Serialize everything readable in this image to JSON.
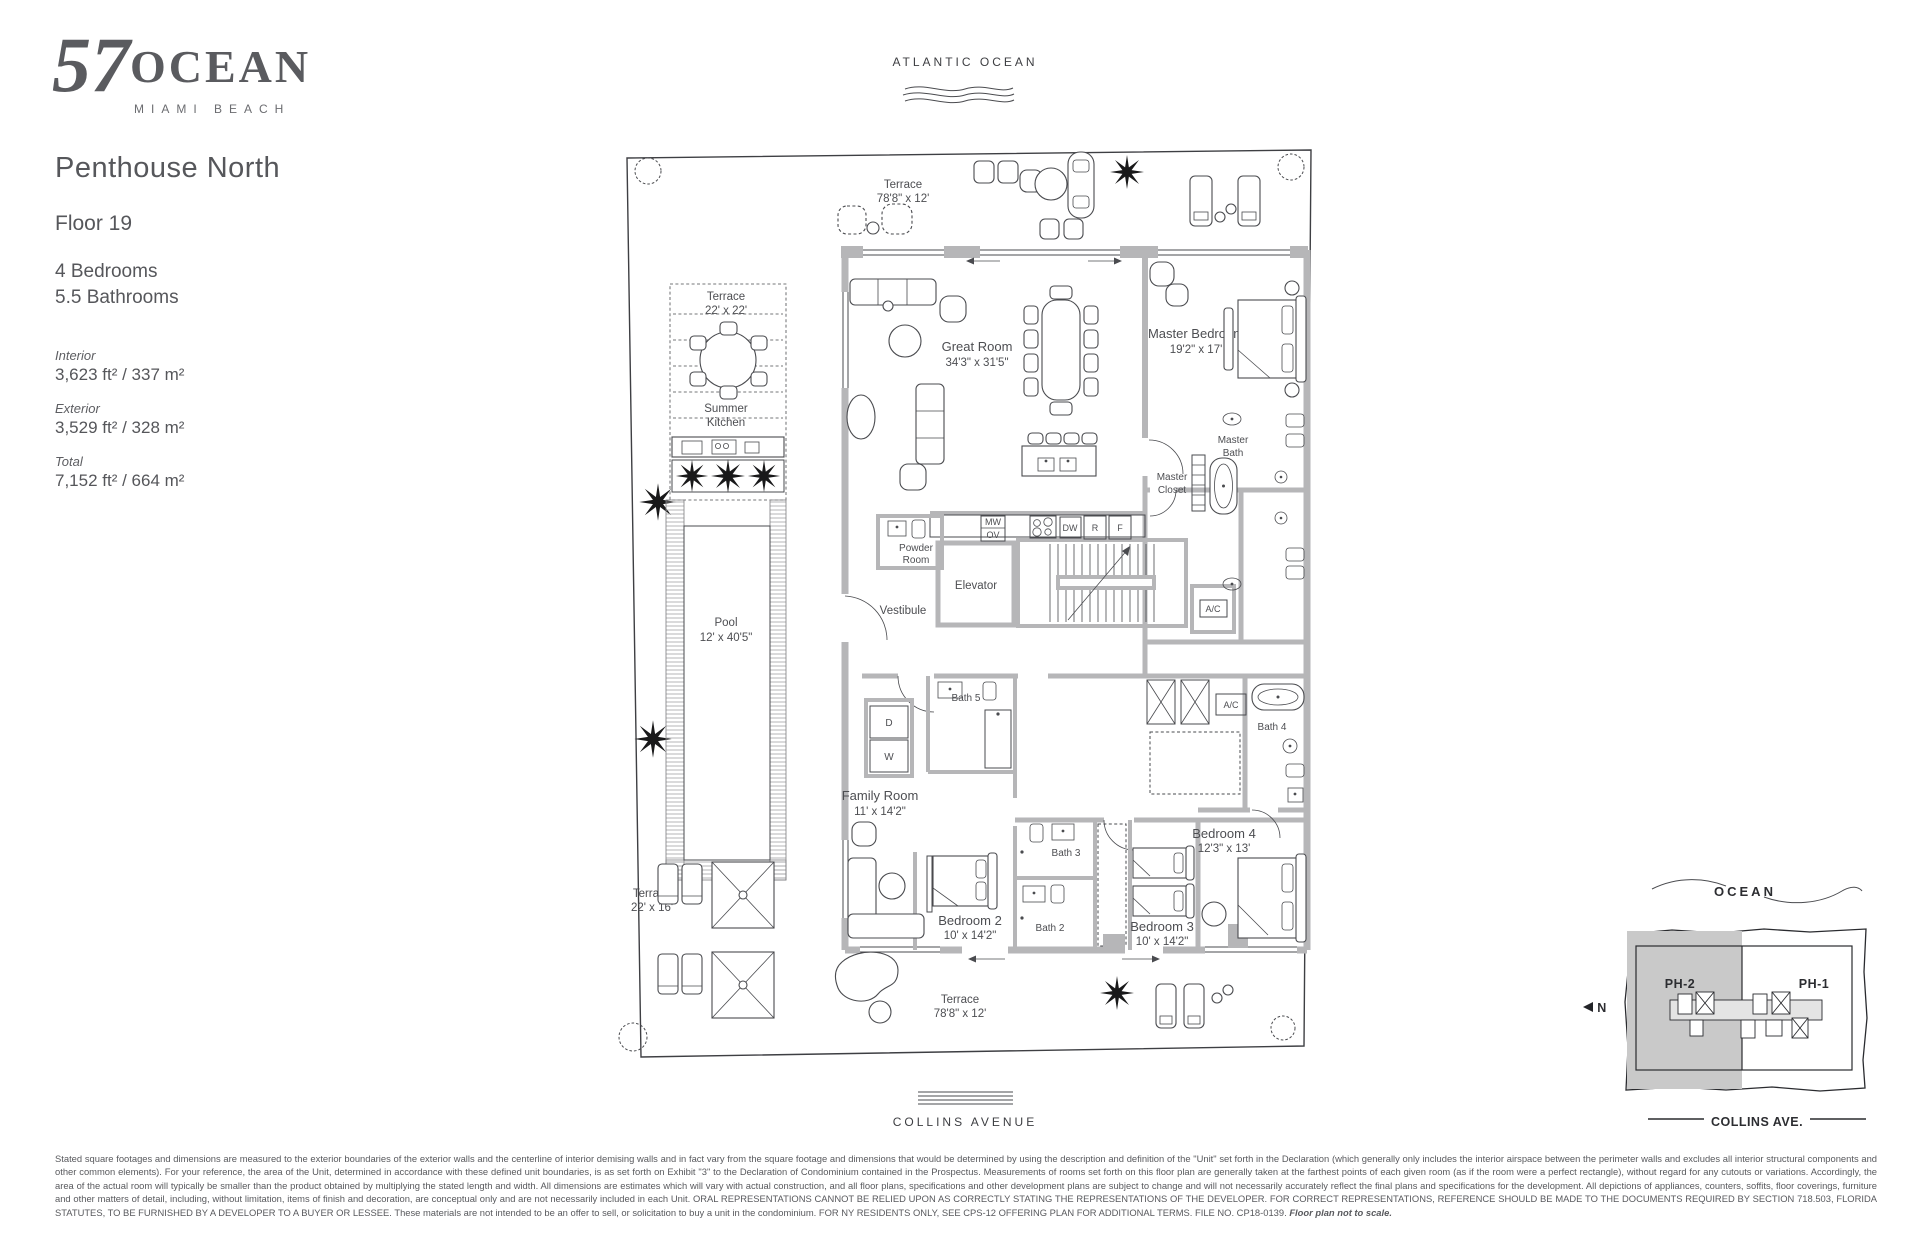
{
  "brand": {
    "number": "57",
    "name": "OCEAN",
    "tagline": "MIAMI BEACH"
  },
  "unit": {
    "title": "Penthouse North",
    "floor": "Floor 19",
    "bedrooms": "4 Bedrooms",
    "bathrooms": "5.5 Bathrooms",
    "stats": [
      {
        "label": "Interior",
        "value": "3,623 ft² / 337 m²"
      },
      {
        "label": "Exterior",
        "value": "3,529 ft² / 328 m²"
      },
      {
        "label": "Total",
        "value": "7,152 ft² / 664 m²"
      }
    ]
  },
  "orientation": {
    "top": "ATLANTIC OCEAN",
    "bottom": "COLLINS AVENUE"
  },
  "plan": {
    "terrace_top": {
      "name": "Terrace",
      "dim": "78'8\" x 12'"
    },
    "terrace_22x22": {
      "name": "Terrace",
      "dim": "22' x 22'"
    },
    "summer_kitchen": {
      "line1": "Summer",
      "line2": "Kitchen"
    },
    "pool": {
      "name": "Pool",
      "dim": "12' x 40'5\""
    },
    "terrace_22x16": {
      "name": "Terrace",
      "dim": "22' x 16'"
    },
    "terrace_bottom": {
      "name": "Terrace",
      "dim": "78'8\" x 12'"
    },
    "great_room": {
      "name": "Great Room",
      "dim": "34'3\" x 31'5\""
    },
    "master_bedroom": {
      "name": "Master Bedroom",
      "dim": "19'2\" x 17'"
    },
    "master_bath": {
      "line1": "Master",
      "line2": "Bath"
    },
    "master_closet": {
      "line1": "Master",
      "line2": "Closet"
    },
    "powder_room": {
      "line1": "Powder",
      "line2": "Room"
    },
    "vestibule": "Vestibule",
    "elevator": "Elevator",
    "family_room": {
      "name": "Family Room",
      "dim": "11' x 14'2\""
    },
    "bedroom2": {
      "name": "Bedroom 2",
      "dim": "10' x 14'2\""
    },
    "bedroom3": {
      "name": "Bedroom 3",
      "dim": "10' x 14'2\""
    },
    "bedroom4": {
      "name": "Bedroom 4",
      "dim": "12'3\" x 13'"
    },
    "bath2": "Bath 2",
    "bath3": "Bath 3",
    "bath4": "Bath 4",
    "bath5": "Bath 5",
    "ac": "A/C",
    "appliances": {
      "mw": "MW",
      "ov": "OV",
      "dw": "DW",
      "r": "R",
      "f": "F"
    },
    "laundry": {
      "d": "D",
      "w": "W"
    }
  },
  "keyplan": {
    "ocean": "OCEAN",
    "unit_highlight": "PH-2",
    "adjacent": "PH-1",
    "north": "N",
    "street": "COLLINS AVE."
  },
  "disclaimer": {
    "body": "Stated square footages and dimensions are measured to the exterior boundaries of the exterior walls and the centerline of interior demising walls and in fact vary from the square footage and dimensions that would be determined by using the description and definition of the \"Unit\" set forth in the Declaration (which generally only includes the interior airspace between the perimeter walls and excludes all interior structural components and other common elements). For your reference, the area of the Unit, determined in accordance with these defined unit boundaries, is as set forth on Exhibit \"3\" to the Declaration of Condominium contained in the Prospectus. Measurements of rooms set forth on this floor plan are generally taken at the farthest points of each given room (as if the room were a perfect rectangle), without regard for any cutouts or variations. Accordingly, the area of the actual room will typically be smaller than the product obtained by multiplying the stated length and width. All dimensions are estimates which will vary with actual construction, and all floor plans, specifications and other development plans are subject to change and will not necessarily accurately reflect the final plans and specifications for the development. All depictions of appliances, counters, soffits, floor coverings, furniture and other matters of detail, including, without limitation, items of finish and decoration, are conceptual only and are not necessarily included in each Unit. ORAL REPRESENTATIONS CANNOT BE RELIED UPON AS CORRECTLY STATING THE REPRESENTATIONS OF THE DEVELOPER. FOR CORRECT REPRESENTATIONS, REFERENCE SHOULD BE MADE TO THE DOCUMENTS REQUIRED BY SECTION 718.503, FLORIDA STATUTES, TO BE FURNISHED BY A DEVELOPER TO A BUYER OR LESSEE. These materials are not intended to be an offer to sell, or solicitation to buy a unit in the condominium. FOR NY RESIDENTS ONLY, SEE CPS-12 OFFERING PLAN FOR ADDITIONAL TERMS. FILE NO. CP18-0139. ",
    "note": "Floor plan not to scale."
  }
}
